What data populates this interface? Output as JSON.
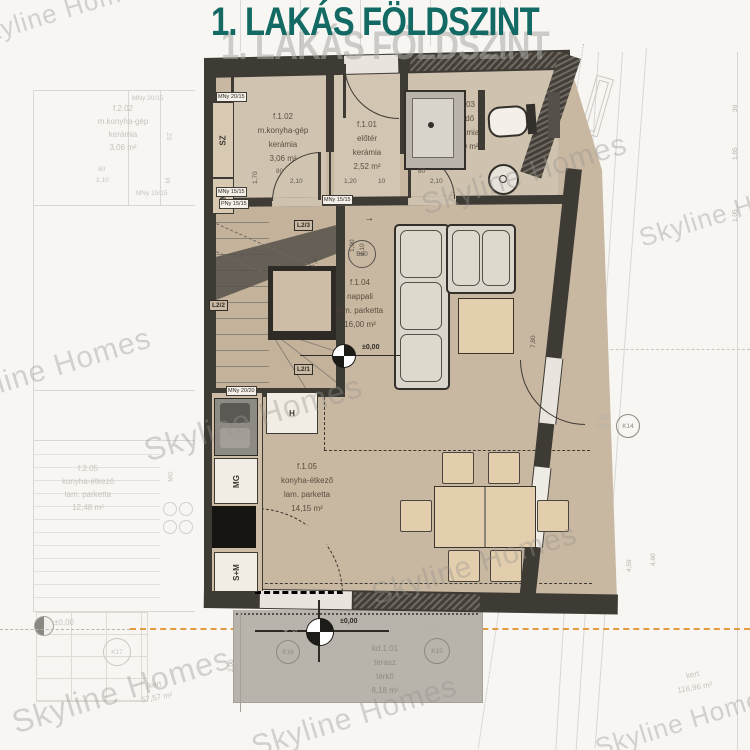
{
  "title": "1. LAKÁS FÖLDSZINT",
  "watermark": "Skyline Homes",
  "arrow": "→",
  "main_unit": {
    "rooms": [
      {
        "id": "f.1.01",
        "name": "előtér",
        "floor": "kerámia",
        "area": "2,52 m²"
      },
      {
        "id": "f.1.02",
        "name": "m.konyha-gép",
        "floor": "kerámia",
        "area": "3,06 m²"
      },
      {
        "id": "f.1.03",
        "name": "fürdő",
        "floor": "kerámia",
        "area": "3,60 m²"
      },
      {
        "id": "f.1.04",
        "name": "nappali",
        "floor": "lam. parketta",
        "area": "16,00 m²"
      },
      {
        "id": "f.1.05",
        "name": "konyha-étkező",
        "floor": "lam. parketta",
        "area": "14,15 m²"
      },
      {
        "id": "kd.1.01",
        "name": "terasz",
        "floor": "térkő",
        "area": "8,18 m²"
      }
    ],
    "appliances": {
      "dryer": "SZ",
      "washer": "M",
      "fridge": "H",
      "dishwasher": "MG",
      "oven_micro": "S+M"
    },
    "vents": {
      "v1": "MNy 20/15",
      "v2": "MNy 15/15",
      "v3": "PNy 15/15",
      "v4": "MNy 20/20",
      "v5": "MNy 15/15"
    },
    "stairs": {
      "s1": "L2/1",
      "s2": "L2/2",
      "s3": "L2/3"
    },
    "tags": {
      "b60": "B60",
      "k14": "K14",
      "k15": "K15",
      "k16": "K16"
    },
    "level": "±0,00",
    "dims": {
      "d120": "1,20",
      "d10": "10",
      "d80": "80",
      "d90": "90",
      "d210": "2,10",
      "d100": "1,00",
      "d170": "1,70",
      "d780": "7,80",
      "d240": "2,40",
      "d180": "1,80",
      "d200": "2,00"
    }
  },
  "background_unit": {
    "rooms": [
      {
        "id": "f.2.02",
        "name": "m.konyha-gép",
        "floor": "kerámia",
        "area": "3,06 m²"
      },
      {
        "id": "f.2.05",
        "name": "konyha-étkező",
        "floor": "lam. parketta",
        "area": "12,48 m²"
      }
    ],
    "labels": {
      "dryer": "SZ",
      "washer": "M",
      "dishwasher": "MG",
      "vent": "MNy 20/15",
      "vent2": "MNy 15/15",
      "door_w": "80",
      "door_h": "2,10",
      "level": "±0,00",
      "tag_k17": "K17",
      "garden": "kert",
      "garden_area": "57,57 m²"
    }
  },
  "site": {
    "garden": "kert",
    "garden_area": "116,96 m²",
    "dims": {
      "d459": "4,59",
      "d460": "4,60",
      "d30": "30",
      "d185": "1,85",
      "d105": "1,05"
    }
  }
}
